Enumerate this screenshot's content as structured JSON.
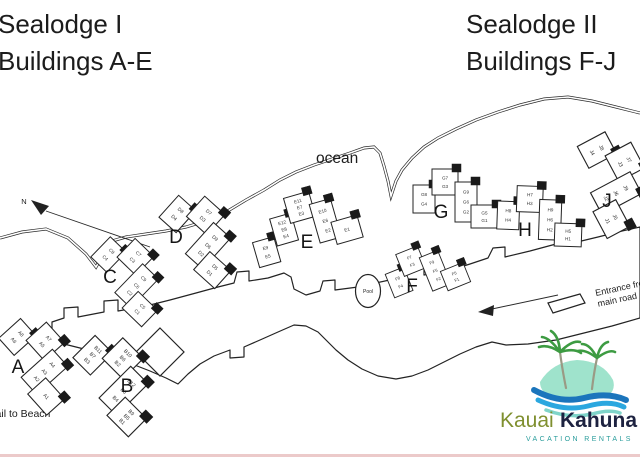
{
  "titles": {
    "left": {
      "line1": "Sealodge I",
      "line2": "Buildings A-E"
    },
    "right": {
      "line1": "Sealodge II",
      "line2": "Buildings F-J"
    }
  },
  "map": {
    "ocean_label": "ocean",
    "north_label": "N",
    "pool_label": "Pool",
    "trail_label": "Trail to Beach",
    "entrance_label_line1": "Entrance from",
    "entrance_label_line2": "main road",
    "buildings": [
      {
        "letter": "A",
        "wings": {
          "left": [
            "A8",
            "A6"
          ],
          "top": [
            "A7",
            "A5"
          ],
          "right": [
            "A4",
            "A3",
            "A2"
          ],
          "bottomRight": [
            "A1"
          ]
        }
      },
      {
        "letter": "B",
        "wings": {
          "left": [
            "B11",
            "B7",
            "B3"
          ],
          "top": [
            "B10",
            "B6",
            "B2"
          ],
          "right": [
            "B12",
            "B8",
            "B4"
          ],
          "bottomRight": [
            "B9",
            "B5",
            "B1"
          ]
        }
      },
      {
        "letter": "C",
        "wings": {
          "left": [
            "C8",
            "C4"
          ],
          "top": [
            "C7",
            "C3"
          ],
          "right": [
            "C9",
            "C6",
            "C2"
          ],
          "bottomRight": [
            "C5",
            "C1"
          ]
        }
      },
      {
        "letter": "D",
        "wings": {
          "left": [
            "D8",
            "D4"
          ],
          "top": [
            "D7",
            "D3"
          ],
          "right": [
            "D9",
            "D6",
            "D2"
          ],
          "bottomRight": [
            "D5",
            "D1"
          ]
        }
      },
      {
        "letter": "E",
        "wings": {
          "leftExtra": [
            "E9",
            "E5"
          ],
          "left": [
            "E12",
            "E8",
            "E4"
          ],
          "top": [
            "E11",
            "E7",
            "E3"
          ],
          "right": [
            "E10",
            "E6",
            "E2"
          ],
          "bottomRight": [
            "E1"
          ]
        }
      },
      {
        "letter": "F",
        "wings": {
          "left": [
            "F8",
            "F4"
          ],
          "top": [
            "F7",
            "F3"
          ],
          "right": [
            "F9",
            "F6",
            "F2"
          ],
          "bottomRight": [
            "F5",
            "F1"
          ]
        }
      },
      {
        "letter": "G",
        "wings": {
          "left": [
            "G8",
            "G4"
          ],
          "top": [
            "G7",
            "G3"
          ],
          "right": [
            "G9",
            "G6",
            "G2"
          ],
          "bottomRight": [
            "G5",
            "G1"
          ]
        }
      },
      {
        "letter": "H",
        "wings": {
          "left": [
            "H8",
            "H4"
          ],
          "top": [
            "H7",
            "H3"
          ],
          "right": [
            "H9",
            "H6",
            "H2"
          ],
          "bottomRight": [
            "H5",
            "H1"
          ]
        }
      },
      {
        "letter": "J",
        "wings": {
          "left": [
            "J8",
            "J4"
          ],
          "top": [
            "J7",
            "J3"
          ],
          "right": [
            "J9",
            "J6",
            "J2"
          ],
          "bottomRight": [
            "J5",
            "J1"
          ]
        }
      }
    ]
  },
  "logo": {
    "brand_first": "Kauai",
    "brand_second": "Kahuna",
    "tagline": "VACATION RENTALS",
    "colors": {
      "island": "#9fe3cc",
      "wave_dark": "#1b75bc",
      "wave_mid": "#2ba7df",
      "wave_light": "#7fd4c9",
      "frond": "#3d9b42",
      "trunk": "#9a9a85",
      "brand_first": "#7f8f2f",
      "brand_second": "#1d2240",
      "tagline": "#2a9d9c"
    }
  }
}
